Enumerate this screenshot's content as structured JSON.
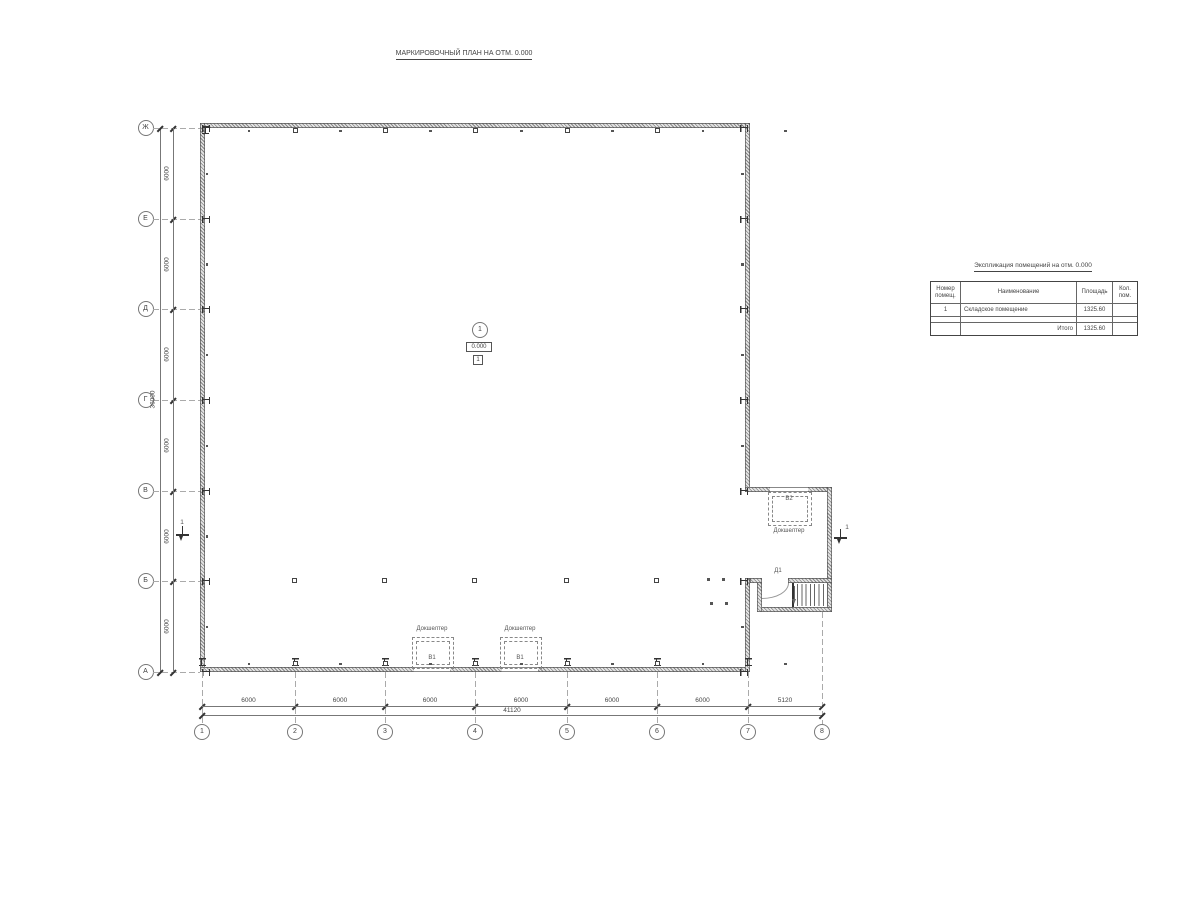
{
  "sheet": {
    "title": "МАРКИРОВОЧНЫЙ ПЛАН НА ОТМ. 0.000"
  },
  "grid": {
    "row_axes": [
      "Ж",
      "Е",
      "Д",
      "Г",
      "В",
      "Б",
      "А"
    ],
    "col_axes": [
      "1",
      "2",
      "3",
      "4",
      "5",
      "6",
      "7",
      "8"
    ]
  },
  "dimensions": {
    "left": {
      "segments": [
        "6000",
        "6000",
        "6000",
        "6000",
        "6000",
        "6000"
      ],
      "total": "36000"
    },
    "bottom": {
      "segments": [
        "6000",
        "6000",
        "6000",
        "6000",
        "6000",
        "6000",
        "5120"
      ],
      "total": "41120"
    }
  },
  "room_tag": {
    "number": "1",
    "elevation": "0.000",
    "floor_type": "1"
  },
  "annotations": {
    "dock_shelter_label": "Докшелтер",
    "gate_tag_1": "В1",
    "gate_tag_2": "В1",
    "gate_tag_3": "В2",
    "door_tag": "Д1",
    "section_mark": "1"
  },
  "spec_table": {
    "title": "Экспликация помещений на отм. 0.000",
    "headers": [
      "Номер помещ.",
      "Наименование",
      "Площадь",
      "Кол. пом."
    ],
    "rows": [
      [
        "1",
        "Складское помещение",
        "1325.60",
        ""
      ],
      [
        "",
        "",
        "",
        ""
      ],
      [
        "",
        "Итого",
        "1325.60",
        ""
      ]
    ]
  }
}
